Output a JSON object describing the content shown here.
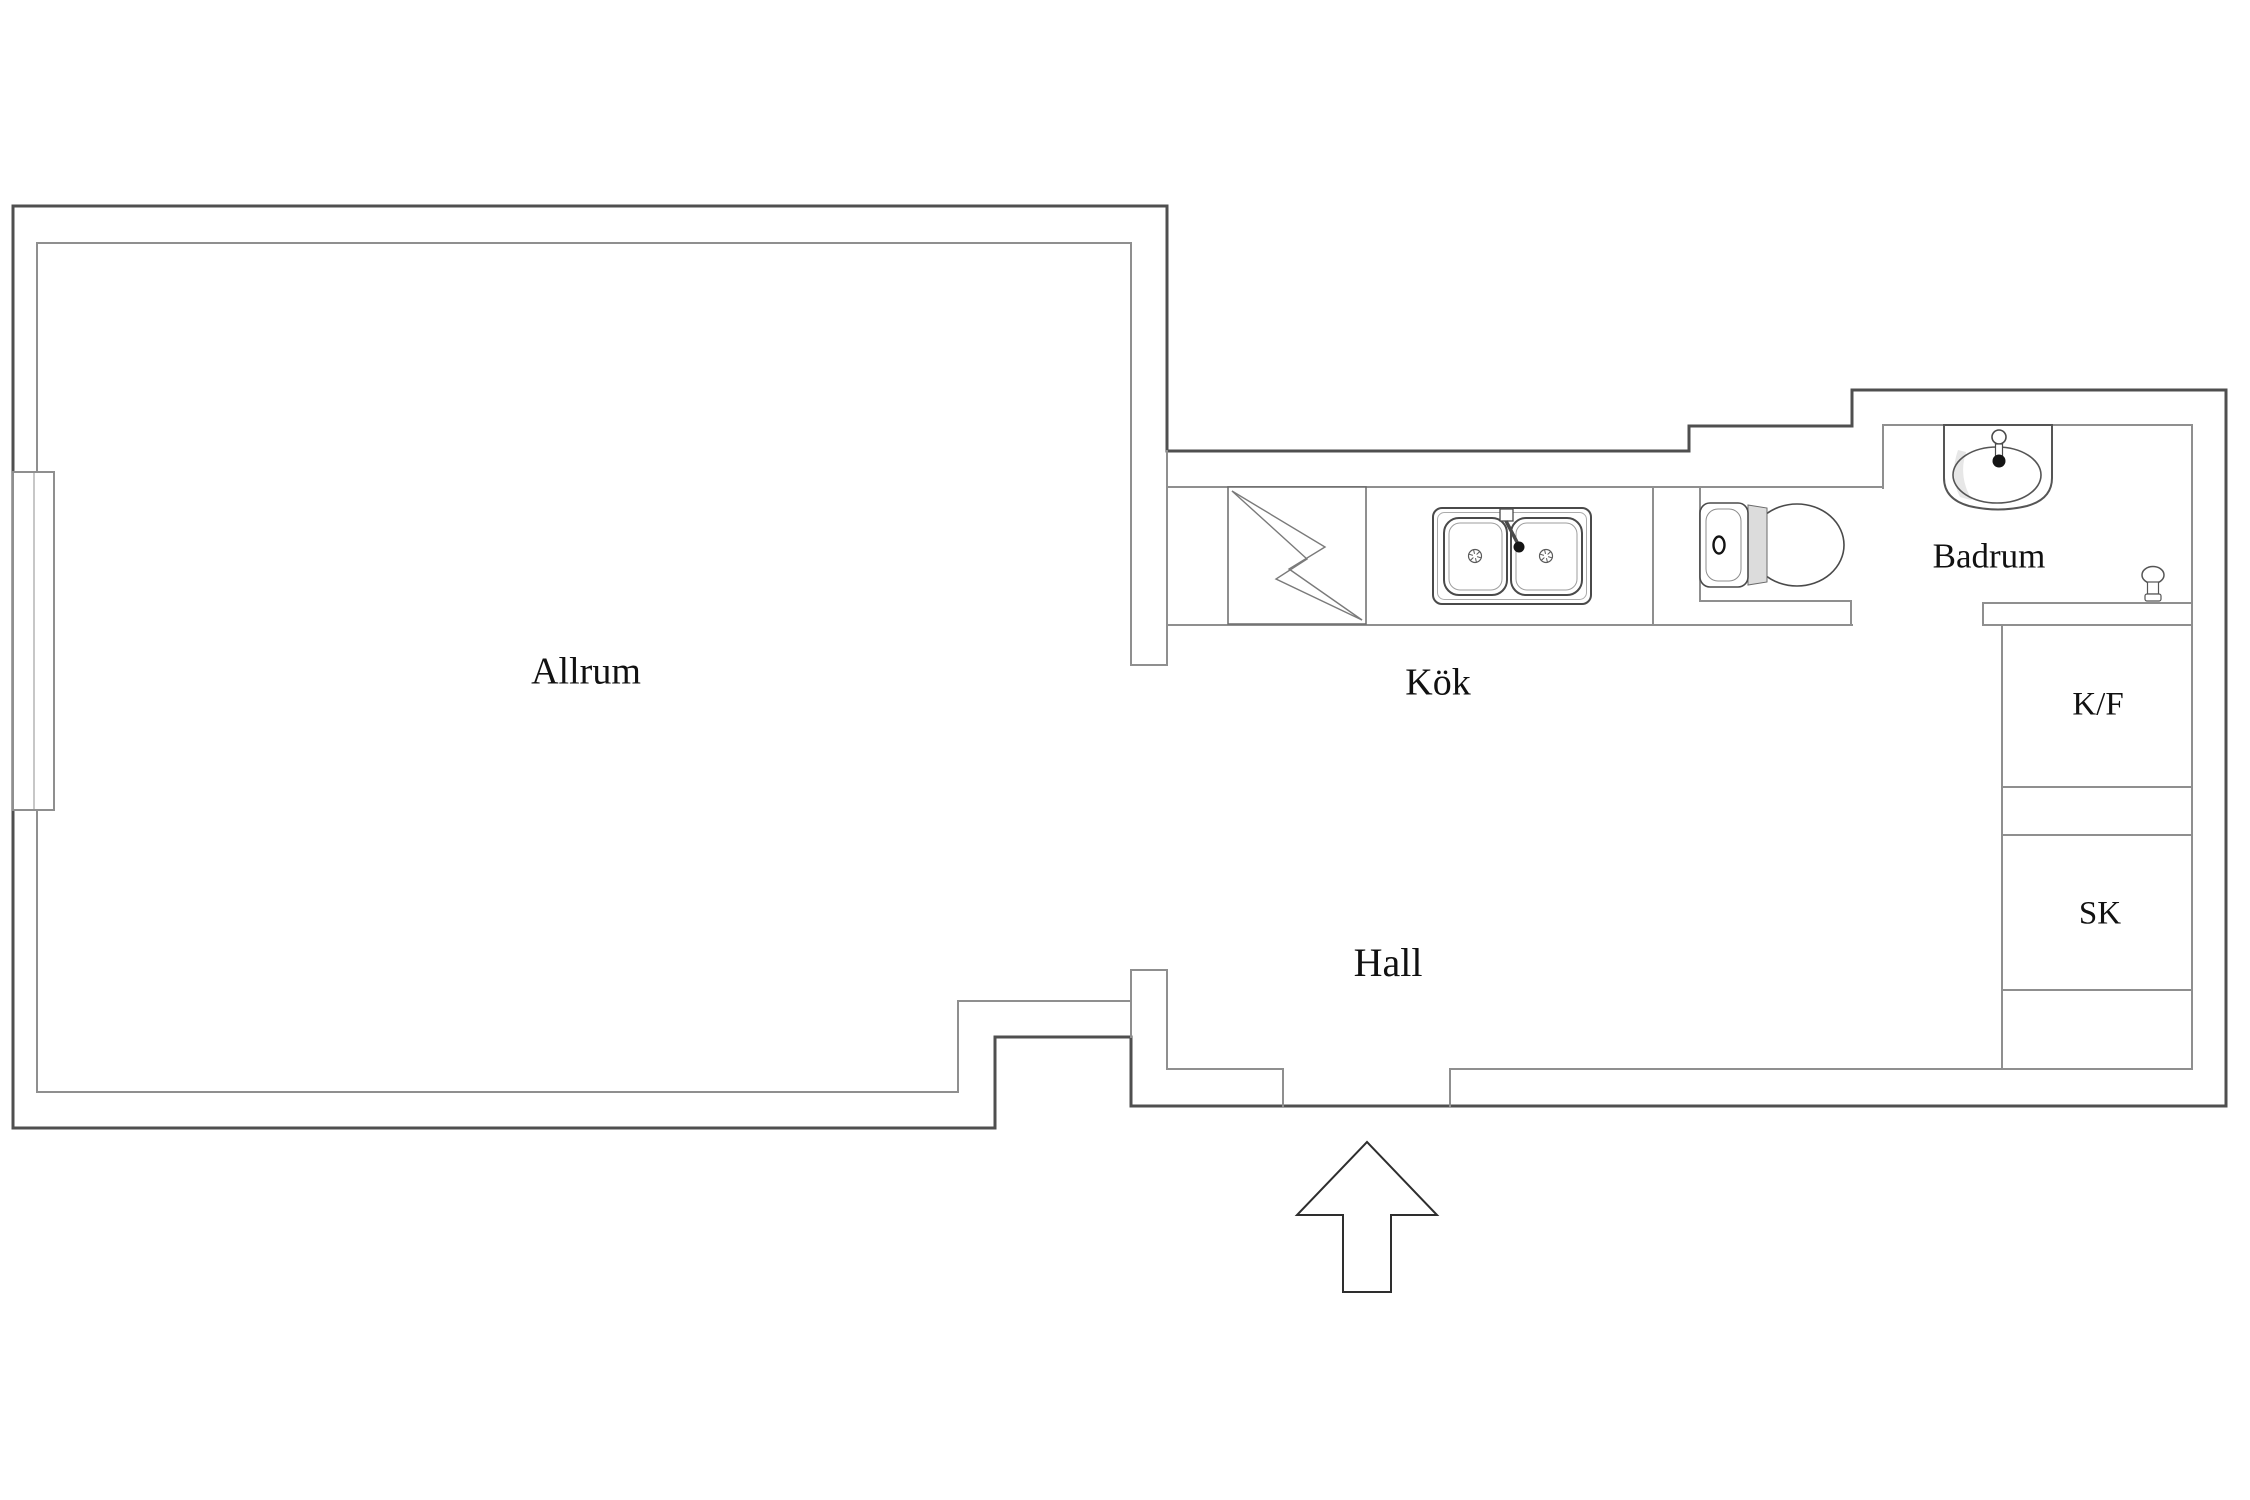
{
  "plan": {
    "canvas": {
      "width": 2250,
      "height": 1500,
      "background": "#ffffff"
    },
    "colors": {
      "wall_outer": "#4f4f4f",
      "wall_inner": "#8f8f8f",
      "fixture": "#4a4a4a",
      "fixture_light": "#9a9a9a",
      "fixture_dark": "#141414",
      "shade": "#dcdcdc",
      "shade_light": "#e7e7e7",
      "arrow_stroke": "#2e2e2e",
      "text": "#111111"
    },
    "labels": [
      {
        "id": "allrum",
        "text": "Allrum",
        "x": 586,
        "y": 670,
        "size": 38
      },
      {
        "id": "kok",
        "text": "Kök",
        "x": 1438,
        "y": 681,
        "size": 38
      },
      {
        "id": "hall",
        "text": "Hall",
        "x": 1388,
        "y": 962,
        "size": 40
      },
      {
        "id": "badrum",
        "text": "Badrum",
        "x": 1989,
        "y": 555,
        "size": 35
      },
      {
        "id": "kf",
        "text": "K/F",
        "x": 2098,
        "y": 703,
        "size": 33
      },
      {
        "id": "sk",
        "text": "SK",
        "x": 2100,
        "y": 912,
        "size": 33
      }
    ],
    "walls_outer": [
      [
        13,
        206,
        1167,
        206
      ],
      [
        13,
        206,
        13,
        1128
      ],
      [
        13,
        1128,
        995,
        1128
      ],
      [
        995,
        1037,
        995,
        1128
      ],
      [
        995,
        1037,
        1131,
        1037
      ],
      [
        1131,
        1037,
        1131,
        1106
      ],
      [
        1131,
        1106,
        2226,
        1106
      ],
      [
        1167,
        206,
        1167,
        451
      ],
      [
        1167,
        451,
        1689,
        451
      ],
      [
        1689,
        426,
        1689,
        451
      ],
      [
        1689,
        426,
        1852,
        426
      ],
      [
        1852,
        390,
        1852,
        426
      ],
      [
        1852,
        390,
        2226,
        390
      ],
      [
        2226,
        390,
        2226,
        1106
      ]
    ],
    "walls_inner": [
      [
        37,
        243,
        1131,
        243
      ],
      [
        37,
        243,
        37,
        1092
      ],
      [
        37,
        1092,
        958,
        1092
      ],
      [
        958,
        1001,
        958,
        1092
      ],
      [
        958,
        1001,
        1131,
        1001
      ],
      [
        1131,
        243,
        1131,
        665
      ],
      [
        1131,
        665,
        1167,
        665
      ],
      [
        1167,
        451,
        1167,
        665
      ],
      [
        1131,
        970,
        1131,
        1037
      ],
      [
        1131,
        970,
        1167,
        970
      ],
      [
        1167,
        970,
        1167,
        1069
      ],
      [
        1167,
        1069,
        1283,
        1069
      ],
      [
        1283,
        1069,
        1283,
        1106
      ],
      [
        1450,
        1069,
        1450,
        1106
      ],
      [
        1450,
        1069,
        2192,
        1069
      ],
      [
        1167,
        487,
        1882,
        487
      ],
      [
        1167,
        625,
        1852,
        625
      ],
      [
        1653,
        487,
        1653,
        625
      ],
      [
        1700,
        487,
        1700,
        601
      ],
      [
        1700,
        601,
        1851,
        601
      ],
      [
        1851,
        601,
        1851,
        625
      ],
      [
        1883,
        425,
        1883,
        488
      ],
      [
        1883,
        425,
        2192,
        425
      ],
      [
        2192,
        425,
        2192,
        1069
      ],
      [
        1983,
        603,
        2192,
        603
      ],
      [
        1983,
        625,
        2192,
        625
      ],
      [
        1983,
        603,
        1983,
        625
      ],
      [
        2002,
        625,
        2002,
        1069
      ],
      [
        2002,
        787,
        2192,
        787
      ],
      [
        2002,
        835,
        2192,
        835
      ],
      [
        2002,
        990,
        2192,
        990
      ]
    ],
    "window": {
      "x": 13,
      "y": 472,
      "width": 41,
      "height": 338,
      "mullion_x": 34
    },
    "entry_arrow": {
      "points": "1367,1142 1437,1215 1391,1215 1391,1292 1343,1292 1343,1215 1297,1215"
    },
    "fixtures": {
      "stove": {
        "x": 1228,
        "y": 487,
        "width": 138,
        "height": 137,
        "bolt_outer": "1232,491 1325,547 1289,569 1362,620",
        "bolt_inner": "1232,491 1307,559 1276,579 1362,620"
      },
      "kitchen_sink": {
        "x": 1433,
        "y": 508,
        "width": 158,
        "height": 96
      },
      "toilet": {
        "x": 1700,
        "y": 503,
        "width": 145,
        "height": 84
      },
      "bathroom_basin": {
        "x": 1944,
        "y": 425,
        "width": 108,
        "height": 85
      },
      "shower_mixer": {
        "x": 2142,
        "y": 566,
        "width": 22,
        "height": 36
      }
    }
  }
}
